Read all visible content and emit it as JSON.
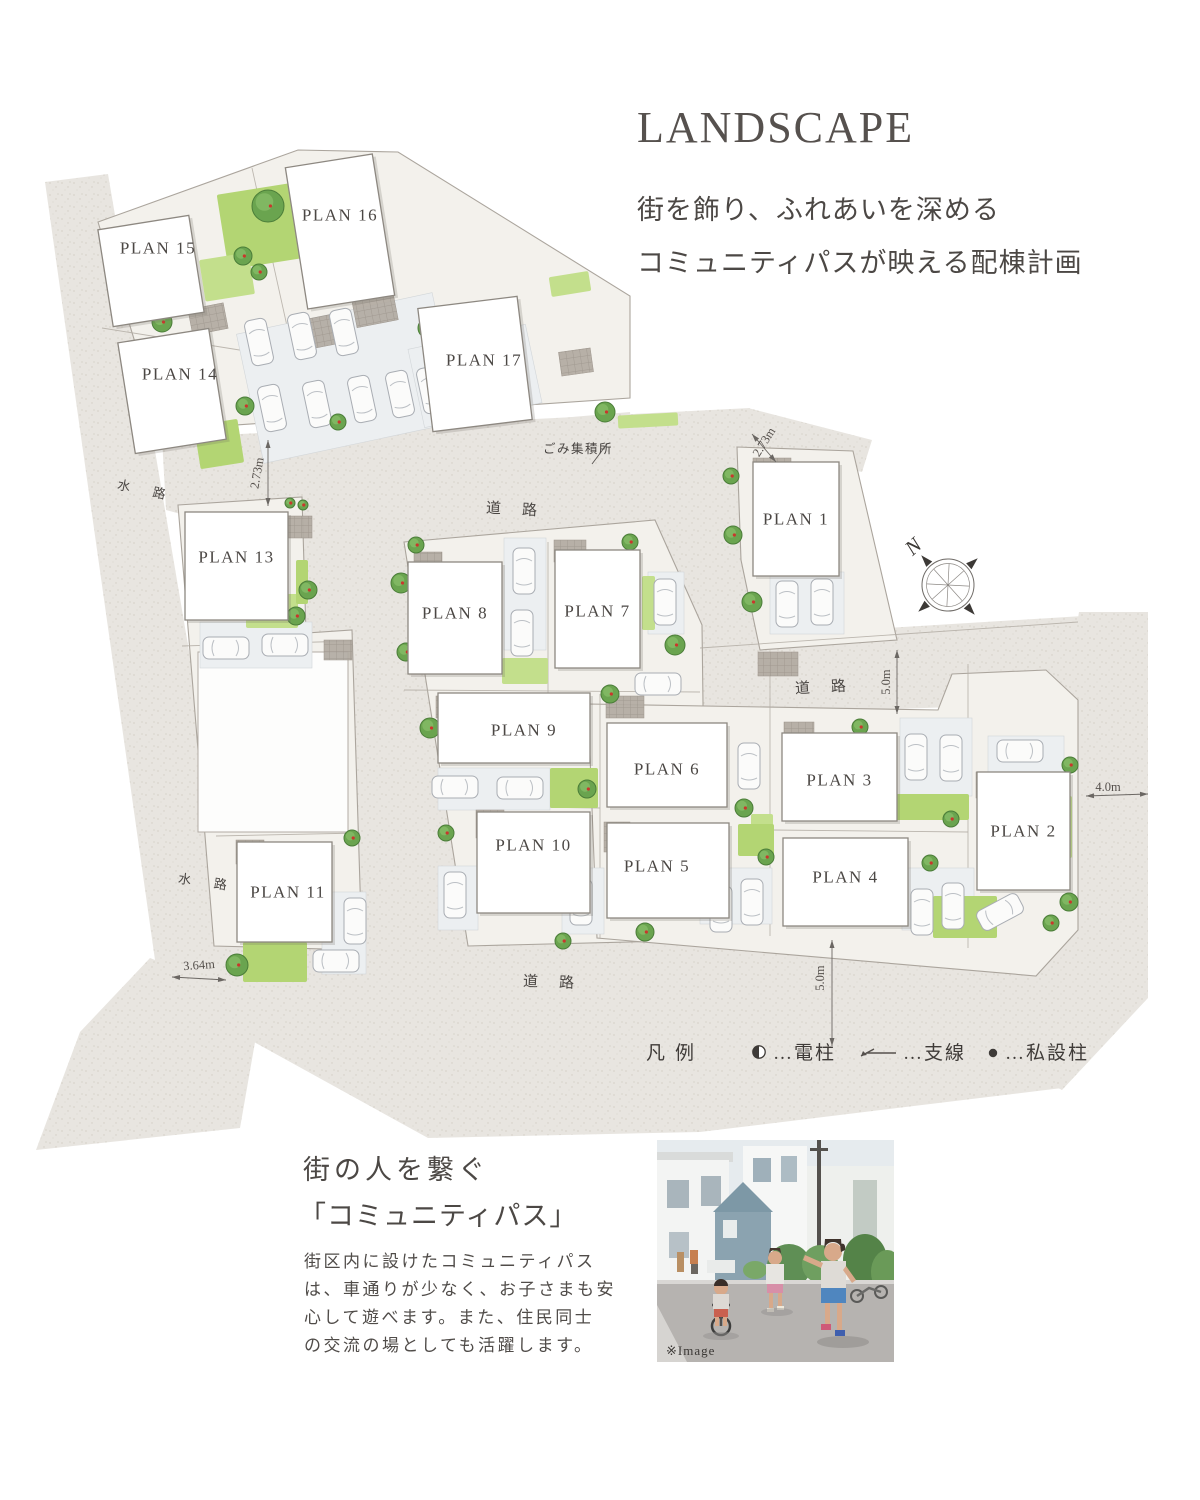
{
  "header": {
    "title": "LANDSCAPE",
    "subtitle_lines": [
      "街を飾り、ふれあいを深める",
      "コミュニティパスが映える配棟計画"
    ]
  },
  "map": {
    "plans": [
      {
        "label": "PLAN 1",
        "x": 753,
        "y": 462,
        "w": 86,
        "h": 114,
        "rot": 0
      },
      {
        "label": "PLAN 2",
        "x": 977,
        "y": 772,
        "w": 93,
        "h": 118,
        "rot": 0
      },
      {
        "label": "PLAN 3",
        "x": 782,
        "y": 733,
        "w": 115,
        "h": 88,
        "rot": 0,
        "ty": 780
      },
      {
        "label": "PLAN 4",
        "x": 783,
        "y": 838,
        "w": 125,
        "h": 88,
        "rot": 0,
        "ty": 877
      },
      {
        "label": "PLAN 5",
        "x": 607,
        "y": 823,
        "w": 122,
        "h": 95,
        "rot": 0,
        "tx": 657,
        "ty": 866
      },
      {
        "label": "PLAN 6",
        "x": 607,
        "y": 723,
        "w": 120,
        "h": 84,
        "rot": 0,
        "ty": 769
      },
      {
        "label": "PLAN 7",
        "x": 555,
        "y": 550,
        "w": 85,
        "h": 118,
        "rot": 0,
        "ty": 611
      },
      {
        "label": "PLAN 8",
        "x": 408,
        "y": 562,
        "w": 94,
        "h": 112,
        "rot": 0,
        "ty": 613
      },
      {
        "label": "PLAN 9",
        "x": 438,
        "y": 693,
        "w": 152,
        "h": 70,
        "rot": 0,
        "tx": 524,
        "ty": 730
      },
      {
        "label": "PLAN 10",
        "x": 477,
        "y": 812,
        "w": 113,
        "h": 101,
        "rot": 0,
        "ty": 845
      },
      {
        "label": "PLAN 11",
        "x": 237,
        "y": 842,
        "w": 95,
        "h": 100,
        "rot": 0,
        "tx": 288
      },
      {
        "label": "PLAN 13",
        "x": 185,
        "y": 512,
        "w": 103,
        "h": 108,
        "rot": 0,
        "ty": 557
      },
      {
        "label": "PLAN 14",
        "x": 126,
        "y": 335,
        "w": 92,
        "h": 112,
        "rot": -9,
        "tx": 180,
        "ty": 374
      },
      {
        "label": "PLAN 15",
        "x": 105,
        "y": 222,
        "w": 92,
        "h": 98,
        "rot": -9,
        "tx": 158,
        "ty": 248
      },
      {
        "label": "PLAN 16",
        "x": 296,
        "y": 160,
        "w": 88,
        "h": 143,
        "rot": -9,
        "ty": 215
      },
      {
        "label": "PLAN 17",
        "x": 425,
        "y": 302,
        "w": 100,
        "h": 124,
        "rot": -7,
        "tx": 484,
        "ty": 360
      }
    ],
    "road_labels": [
      {
        "text": "道　路",
        "x": 513,
        "y": 510,
        "rot": 3
      },
      {
        "text": "道　路",
        "x": 822,
        "y": 688,
        "rot": -3
      },
      {
        "text": "道　路",
        "x": 550,
        "y": 983,
        "rot": 2
      }
    ],
    "water_labels": [
      {
        "text": "水　路",
        "x": 144,
        "y": 490,
        "rot": 12
      },
      {
        "text": "水　路",
        "x": 205,
        "y": 882,
        "rot": 8
      }
    ],
    "dimensions": [
      {
        "text": "2.73m",
        "x": 257,
        "y": 473,
        "rot": -80
      },
      {
        "text": "2.73m",
        "x": 764,
        "y": 442,
        "rot": -58
      },
      {
        "text": "5.0m",
        "x": 886,
        "y": 682,
        "rot": -90
      },
      {
        "text": "5.0m",
        "x": 820,
        "y": 978,
        "rot": -90
      },
      {
        "text": "4.0m",
        "x": 1108,
        "y": 787,
        "rot": 0
      },
      {
        "text": "3.64m",
        "x": 199,
        "y": 965,
        "rot": -4
      }
    ],
    "garbage_label": "ごみ集積所",
    "compass_label": "N",
    "legend": {
      "title": "凡例",
      "items": [
        {
          "icon": "utility-pole",
          "text": "…電柱"
        },
        {
          "icon": "guy-wire",
          "text": "…支線"
        },
        {
          "icon": "private-pole",
          "text": "…私設柱"
        }
      ]
    }
  },
  "community": {
    "heading_lines": [
      "街の人を繋ぐ",
      "「コミュニティパス」"
    ],
    "body_lines": [
      "街区内に設けたコミュニティパス",
      "は、車通りが少なく、お子さまも安",
      "心して遊べます。また、住民同士",
      "の交流の場としても活躍します。"
    ],
    "image_caption": "※Image"
  },
  "colors": {
    "text": "#4d4946",
    "road": "#e8e5e0",
    "plot": "#f3f1ec",
    "grass": "#b5d575",
    "tree": "#69a34e",
    "building": "#ffffff"
  }
}
